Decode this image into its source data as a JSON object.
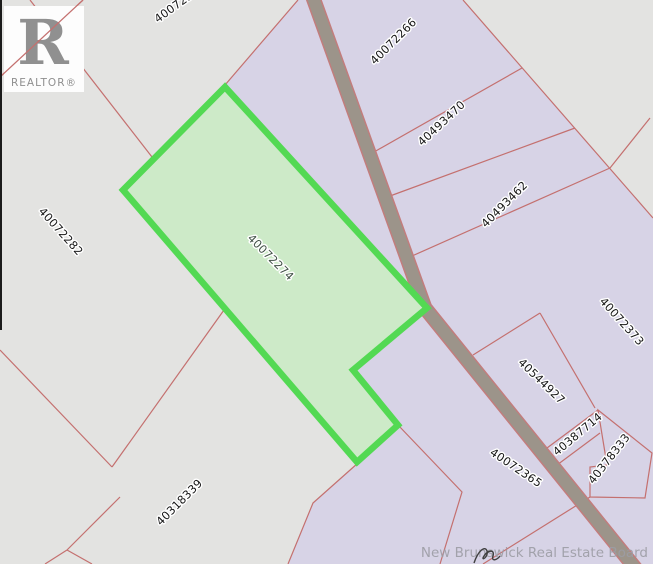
{
  "map": {
    "description_title": "Property parcel map",
    "watermark": "New Brunswick Real Estate Board",
    "logo": {
      "letter": "R",
      "word": "REALTOR®"
    },
    "highlighted_parcel_id": "40072274",
    "parcels": [
      {
        "id": "40072266"
      },
      {
        "id": "40493470"
      },
      {
        "id": "40493462"
      },
      {
        "id": "40072373"
      },
      {
        "id": "40072274"
      },
      {
        "id": "40072282"
      },
      {
        "id": "40544927"
      },
      {
        "id": "40387714"
      },
      {
        "id": "40378333"
      },
      {
        "id": "40072365"
      },
      {
        "id": "40318339"
      },
      {
        "id": "400722"
      }
    ],
    "colors": {
      "background_gray": "#e3e3e1",
      "parcel_lavender": "#d7d3e6",
      "highlight_green_fill": "#cdeac8",
      "highlight_green_stroke": "#53d953",
      "road_fill": "#9c948a",
      "road_edge": "#c27d7d",
      "boundary_red": "#c4706f",
      "parcel_beige": "#edebe3",
      "label_text": "#161616",
      "watermark_gray": "#9c9ca4"
    }
  }
}
